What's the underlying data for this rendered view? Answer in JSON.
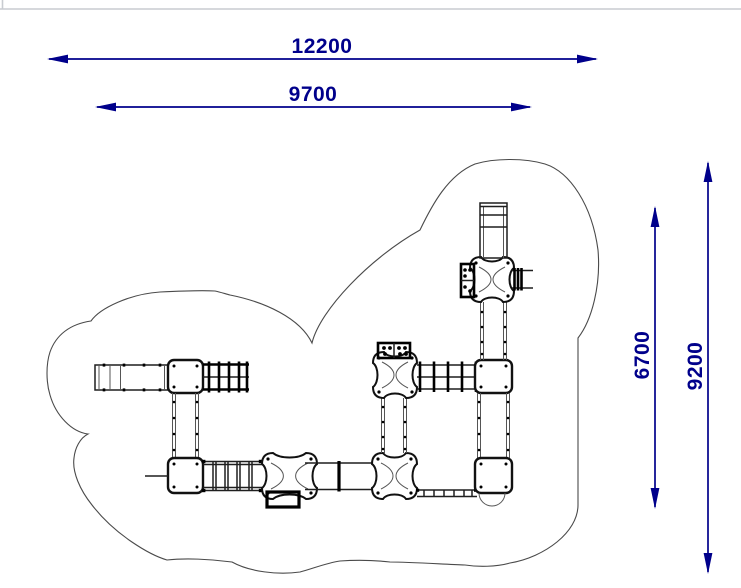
{
  "drawing": {
    "kind": "technical-plan-view",
    "subject": "playground-structure-with-safety-area-outline"
  },
  "dimensions": {
    "top_outer": {
      "value": "12200",
      "orientation": "horizontal"
    },
    "top_inner": {
      "value": "9700",
      "orientation": "horizontal"
    },
    "right_inner": {
      "value": "6700",
      "orientation": "vertical"
    },
    "right_outer": {
      "value": "9200",
      "orientation": "vertical"
    }
  },
  "colors": {
    "dimension_blue": "#00008B",
    "outline_gray": "#4a4a4a",
    "equipment_black": "#111111",
    "frame_gray": "#c9ccd1",
    "background": "#ffffff"
  }
}
